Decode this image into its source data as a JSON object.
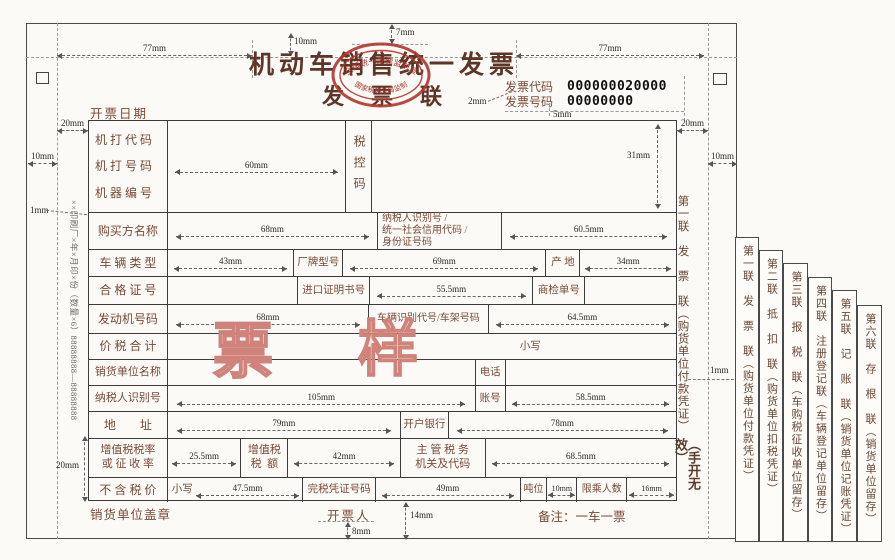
{
  "colors": {
    "label_red_brown": "#7b4a38",
    "title_color": "#5f3527",
    "stamp_red": "#b2342c",
    "watermark_pink": "#cf837a",
    "line_color": "#3d3d3d"
  },
  "title": {
    "main": "机动车销售统一发票",
    "sub": "发票联"
  },
  "stamp": {
    "arc_top": "全国统一发票监制章",
    "arc_bottom": "国家税务总局监制"
  },
  "invoice_code": {
    "label": "发票代码",
    "value": "000000020000"
  },
  "invoice_number": {
    "label": "发票号码",
    "value": "00000000"
  },
  "date_label": "开票日期",
  "rows": {
    "machine_code": "机 打 代 码",
    "machine_no": "机 打 号 码",
    "machine_id": "机 器 编 号",
    "tax_control": "税控码",
    "buyer": "购买方名称",
    "taxid_l1": "纳税人识别号 /",
    "taxid_l2": "统一社会信用代码 /",
    "taxid_l3": "身份证号码",
    "vehicle_type": "车 辆 类 型",
    "brand_model": "厂牌型号",
    "origin": "产 地",
    "cert_no": "合 格 证 号",
    "import_cert": "进口证明书号",
    "inspection_no": "商检单号",
    "engine_no": "发动机号码",
    "vin": "车辆识别代号/车架号码",
    "total": "价 税 合 计",
    "small_caps": "小写",
    "seller": "销货单位名称",
    "phone": "电话",
    "taxpayer_id": "纳税人识别号",
    "account": "账号",
    "address": "地　　址",
    "bank": "开户银行",
    "vat_rate_l1": "增值税税率",
    "vat_rate_l2": "或 征 收 率",
    "vat_amount_l1": "增值税",
    "vat_amount_l2": "税  额",
    "tax_authority_l1": "主 管 税 务",
    "tax_authority_l2": "机关及代码",
    "price_no_tax": "不 含 税 价",
    "tax_cert_no": "完税凭证号码",
    "tonnage": "吨位",
    "passengers": "限乘人数"
  },
  "footer": {
    "seal": "销货单位盖章",
    "drawer": "开票人",
    "note": "备注：一车一票"
  },
  "watermark": {
    "char1": "票",
    "char2": "样"
  },
  "inner_copy": {
    "text": "第一联　发　票　联（购货单位付款凭证）",
    "invalid": "（手开无效）"
  },
  "copies": [
    "第一联　发　票　联（购货单位付款凭证）",
    "第二联　抵　扣　联（购货单位扣税凭证）",
    "第三联　报　税　联（车购税征收单位留存）",
    "第四联　注册登记联（车辆登记单位留存）",
    "第五联　记　账　联（销货单位记账凭证）",
    "第六联　存　根　联（销货单位留存）"
  ],
  "printer_line": "××印刷厂×年×月印×份（数量×6）88888888—88888888",
  "mm": {
    "m1": "1mm",
    "m2": "2mm",
    "m5": "5mm",
    "m7": "7mm",
    "m8": "8mm",
    "m10": "10mm",
    "m14": "14mm",
    "m16": "16mm",
    "m20": "20mm",
    "m25_5": "25.5mm",
    "m31": "31mm",
    "m34": "34mm",
    "m42": "42mm",
    "m43": "43mm",
    "m47_5": "47.5mm",
    "m49": "49mm",
    "m55_5": "55.5mm",
    "m58_5": "58.5mm",
    "m60": "60mm",
    "m60_5": "60.5mm",
    "m64_5": "64.5mm",
    "m68": "68mm",
    "m68_5": "68.5mm",
    "m69": "69mm",
    "m77": "77mm",
    "m78": "78mm",
    "m79": "79mm",
    "m105": "105mm"
  }
}
